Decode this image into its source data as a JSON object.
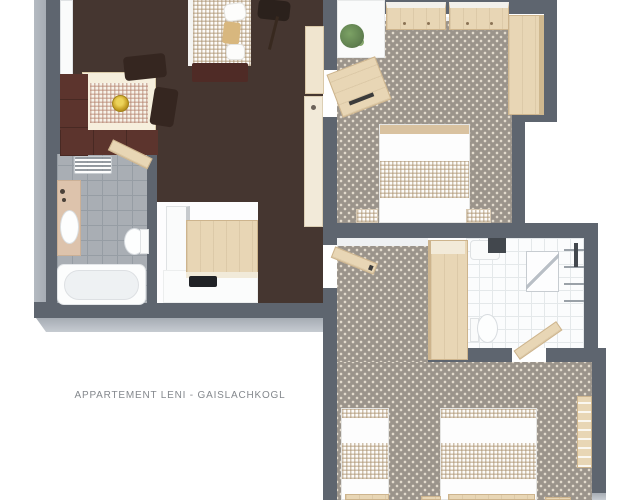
{
  "floorplan": {
    "title": "APPARTEMENT LENI - GAISLACHKOGL"
  },
  "colors": {
    "bg": "#ffffff",
    "wall": "#5e656f",
    "wall_face": "#a6acb4",
    "wall_inner": "#eff1f3",
    "living_floor": "#453630",
    "carpet": "#9b948b",
    "carpet_dot": "#e4dcce",
    "tile_gray": "#a9aeb4",
    "tile_gray_grout": "#969da4",
    "tile_white": "#fbfcfd",
    "tile_white_grout": "#e4e8ea",
    "wood": "#e8d6b5",
    "wood_edge": "#cdb48d",
    "wood_dark": "#d9c2a0",
    "cream": "#f0e5cf",
    "white_furn": "#fafbfb",
    "furn_border": "#dfe2e4",
    "maroon": "#5c342d",
    "maroon_dark": "#4f2b26",
    "dark_chair": "#352620",
    "gold": "#c9a227",
    "plant_green": "#5f7f4f",
    "metal": "#9aa1a8",
    "dark_item": "#42474d",
    "text": "#84888d"
  }
}
